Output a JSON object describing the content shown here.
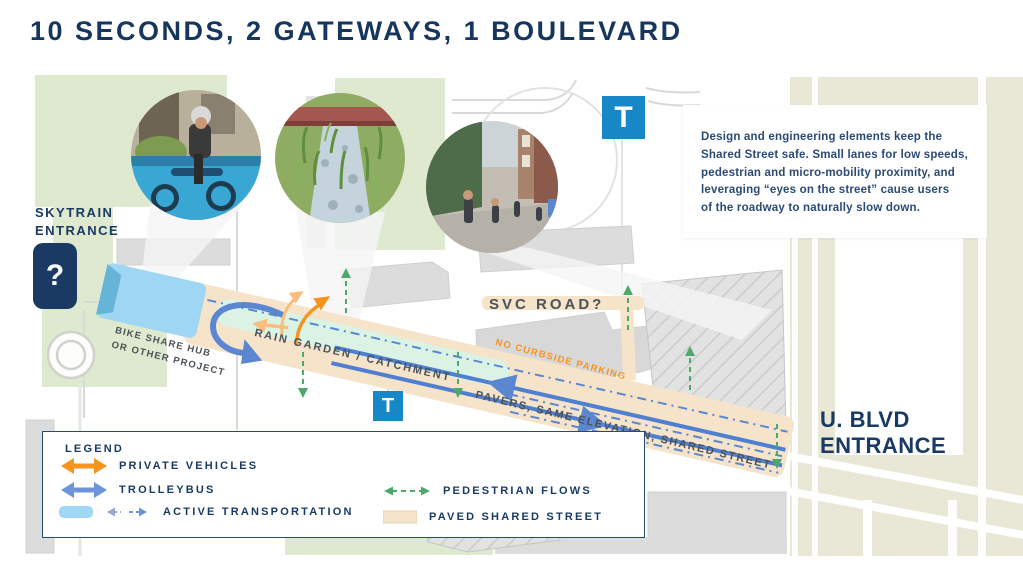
{
  "title": "10 SECONDS, 2 GATEWAYS, 1 BOULEVARD",
  "callout": "Design and engineering elements keep the\nShared Street safe. Small lanes for low speeds,\npedestrian and micro-mobility proximity, and\nleveraging “eyes on the street” cause users\nof the roadway to naturally slow down.",
  "map_labels": {
    "skytrain_entrance": "SKYTRAIN\nENTRANCE",
    "skytrain_symbol": "?",
    "transit_symbol": "T",
    "bike_share_hub": "BIKE SHARE HUB\nOR OTHER PROJECT",
    "rain_garden": "RAIN GARDEN / CATCHMENT",
    "svc_road": "SVC ROAD?",
    "no_curbside_parking": "NO CURBSIDE PARKING",
    "pavers": "PAVERS, SAME ELEVATION, SHARED STREET",
    "shade": "SHADE AND OTHER FRONTAGE ELEMENTS",
    "u_blvd_entrance": "U. BLVD\nENTRANCE"
  },
  "legend": {
    "heading": "LEGEND",
    "items": [
      {
        "label": "PRIVATE VEHICLES",
        "symbol": "orange-double-arrow"
      },
      {
        "label": "TROLLEYBUS",
        "symbol": "blue-double-arrow"
      },
      {
        "label": "ACTIVE TRANSPORTATION",
        "symbol": "light-blue-lane-with-dashed-arrows"
      },
      {
        "label": "PEDESTRIAN FLOWS",
        "symbol": "green-dashed-double-arrow"
      },
      {
        "label": "PAVED SHARED STREET",
        "symbol": "tan-swatch"
      }
    ]
  },
  "photos": [
    {
      "name": "bike-share-station"
    },
    {
      "name": "rain-garden-stream"
    },
    {
      "name": "shared-street-pedestrians"
    }
  ],
  "colors": {
    "navy": "#1A3A63",
    "title_navy": "#17365D",
    "private_vehicle_orange": "#F7941D",
    "trolleybus_blue": "#5B87D0",
    "active_transport_blue": "#9ED6F3",
    "transit_t_blue": "#1787C8",
    "pedestrian_green": "#4CA96B",
    "paved_street_tan": "#F5E3CA",
    "rain_garden_mint": "#DAF3E4",
    "map_green": "#DEE9D0",
    "map_beige": "#E9E8D6",
    "building_gray": "#DCDCDC"
  }
}
